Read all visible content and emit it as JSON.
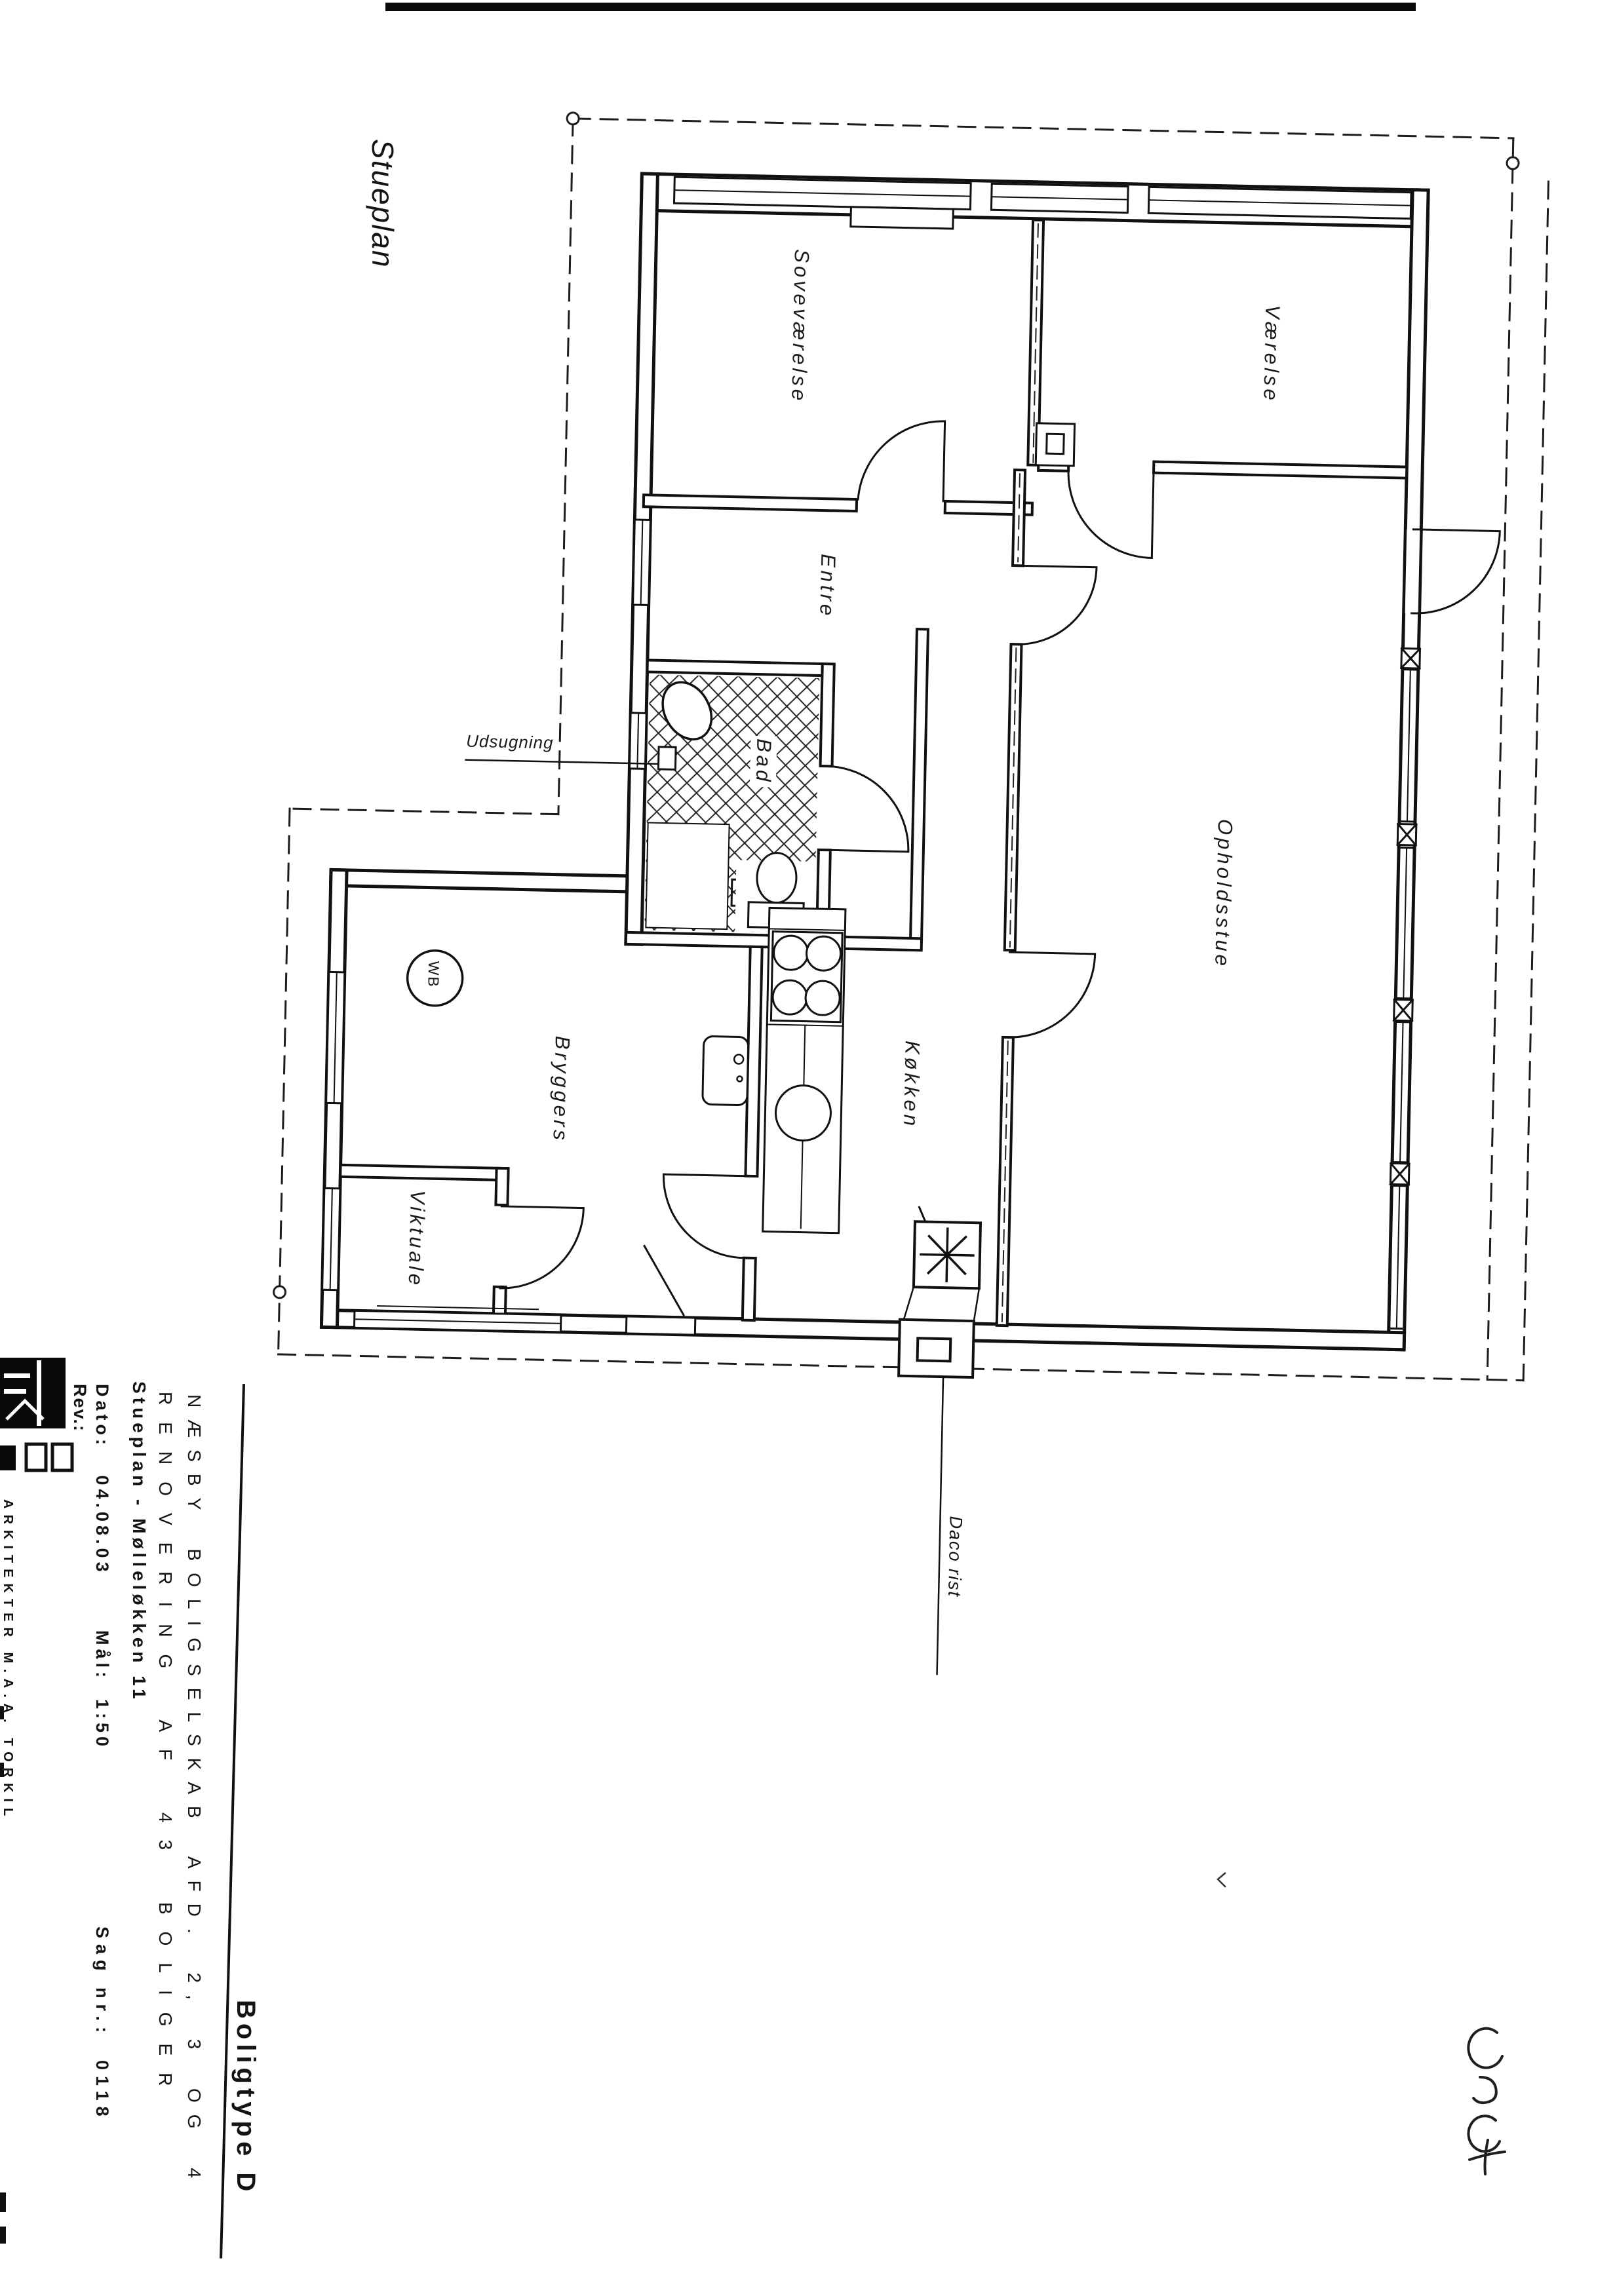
{
  "page": {
    "plan_title": "Stueplan"
  },
  "plan": {
    "rooms": [
      {
        "id": "sovevaerelse",
        "label": "Soveværelse"
      },
      {
        "id": "vaerelse",
        "label": "Værelse"
      },
      {
        "id": "entre",
        "label": "Entre"
      },
      {
        "id": "bad",
        "label": "Bad"
      },
      {
        "id": "opholdsstue",
        "label": "Opholdsstue"
      },
      {
        "id": "koekken",
        "label": "Køkken"
      },
      {
        "id": "bryggers",
        "label": "Bryggers"
      },
      {
        "id": "viktuale",
        "label": "Viktuale"
      }
    ],
    "annotations": {
      "udsugning": "Udsugning",
      "daco_rist": "Daco rist",
      "washer": "WB",
      "handwritten_note": "C3C+"
    }
  },
  "title_block": {
    "project_line1": "NÆSBY BOLIGSELSKAB AFD. 2, 3 OG 4",
    "project_line2": "RENOVERING AF 43 BOLIGER",
    "drawing_line": "Stueplan - Mølleløkken 11",
    "dato": "Dato:   04.08.03",
    "maal": "Mål:  1:50",
    "sag": "Sag nr.:  0118",
    "rev": "Rev.:",
    "boligtype": "Boligtype D",
    "architects": "ARKITEKTER M.A.A. TORKIL"
  },
  "colors": {
    "ink": "#141414",
    "paper": "#ffffff"
  }
}
